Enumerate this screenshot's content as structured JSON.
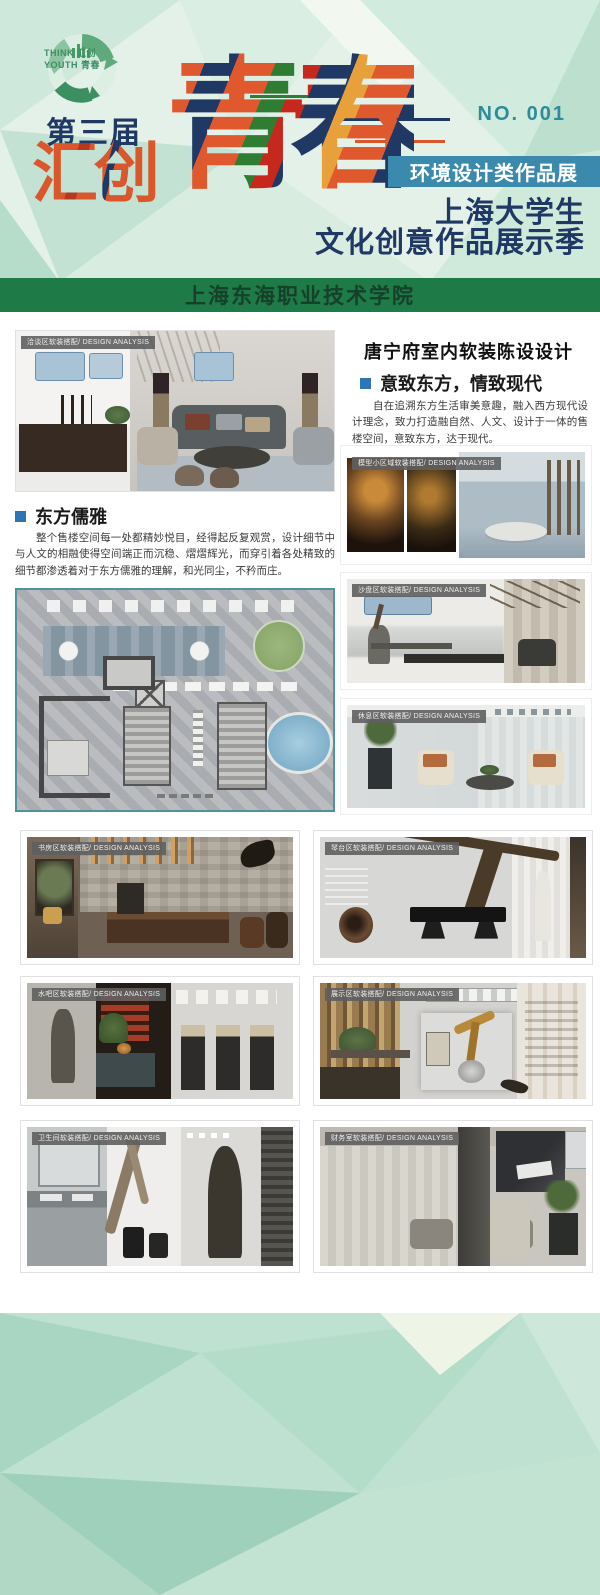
{
  "poster": {
    "logo": {
      "line1": "THINK 汇创",
      "line2": "YOUTH 青春"
    },
    "issue_number": "NO. 001",
    "edition": "第三届",
    "brand_word1": "汇创",
    "brand_word2": "青春",
    "category_banner": "环境设计类作品展",
    "subtitle_line1": "上海大学生",
    "subtitle_line2": "文化创意作品展示季",
    "school": "上海东海职业技术学院"
  },
  "content": {
    "project_title": "唐宁府室内软装陈设设计",
    "concept": {
      "heading": "意致东方，情致现代",
      "body": "自在追溯东方生活审美意趣，融入西方现代设计理念，致力打造融自然、人文、设计于一体的售楼空间，意致东方，达于现代。"
    },
    "section_east": {
      "heading": "东方儒雅",
      "body": "整个售楼空间每一处都精妙悦目，经得起反复观赏，设计细节中与人文的相融使得空间端正而沉稳、熠熠辉光，而穿引着各处精致的细节都渗透着对于东方儒雅的理解，和光同尘，不矜而庄。"
    },
    "gallery": {
      "items": [
        {
          "caption": "洽谈区软装搭配/ DESIGN ANALYSIS"
        },
        {
          "caption": "模型小区域软装搭配/ DESIGN ANALYSIS"
        },
        {
          "caption": "沙盘区软装搭配/ DESIGN ANALYSIS"
        },
        {
          "caption": "休息区软装搭配/ DESIGN ANALYSIS"
        },
        {
          "caption": "书房区软装搭配/ DESIGN ANALYSIS"
        },
        {
          "caption": "琴台区软装搭配/ DESIGN ANALYSIS"
        },
        {
          "caption": "水吧区软装搭配/ DESIGN ANALYSIS"
        },
        {
          "caption": "展示区软装搭配/ DESIGN ANALYSIS"
        },
        {
          "caption": "卫生间软装搭配/ DESIGN ANALYSIS"
        },
        {
          "caption": "财务室软装搭配/ DESIGN ANALYSIS"
        }
      ]
    }
  },
  "colors": {
    "navy": "#203864",
    "orange": "#d9572b",
    "band_blue": "#3c89ae",
    "bar_green": "#1e7a46",
    "number_teal": "#2d8c9c",
    "bullet_blue": "#2e75b6",
    "mint": "#cfe7db"
  }
}
